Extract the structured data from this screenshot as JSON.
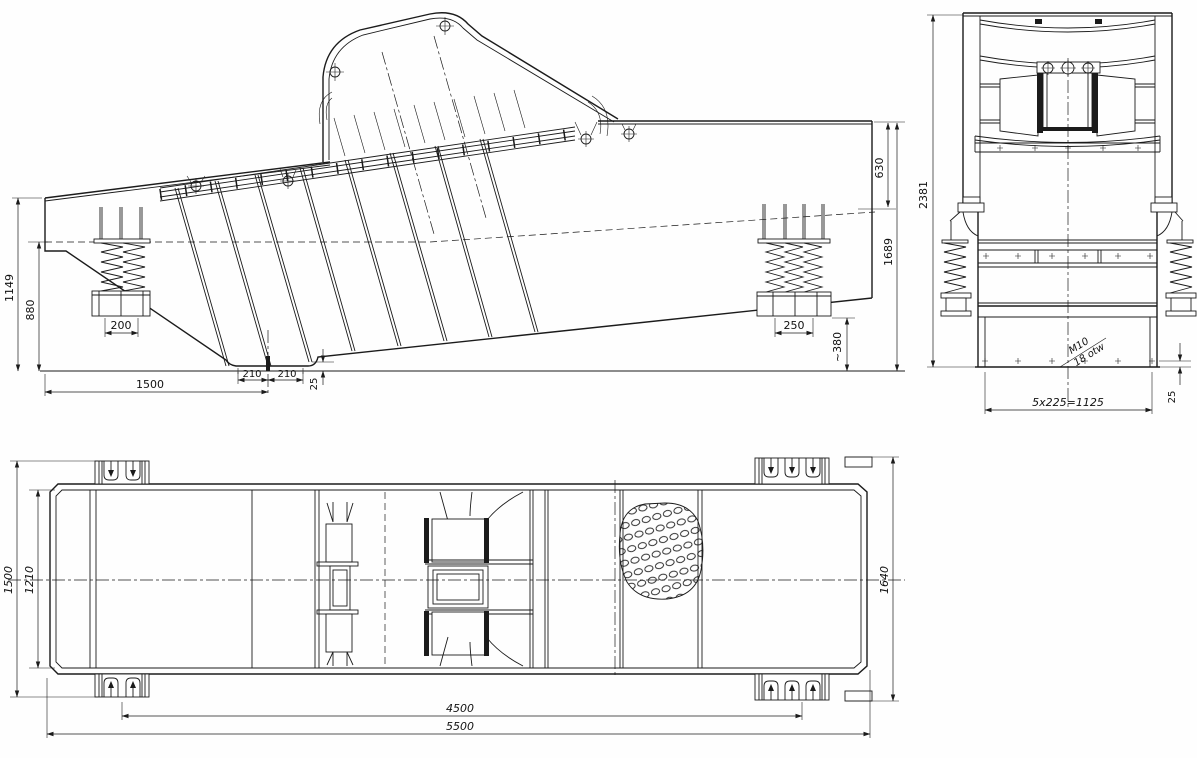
{
  "drawing": {
    "type": "engineering-3-view-drawing",
    "subject": "vibrating-screen-machine",
    "line_color": "#1b1b1b",
    "background": "#fefefe"
  },
  "views": {
    "side": {
      "label": "side-view",
      "dims": {
        "d1149": "1149",
        "d880": "880",
        "d200": "200",
        "d1500": "1500",
        "d210a": "210",
        "d210b": "210",
        "d25": "25",
        "d250": "250",
        "d380": "~380",
        "d630": "630",
        "d1689": "1689"
      }
    },
    "end": {
      "label": "end-view",
      "dims": {
        "d2381": "2381",
        "d1125": "5x225=1125",
        "d25": "25",
        "m10": "M10",
        "otw": "18 otw"
      }
    },
    "plan": {
      "label": "plan-view",
      "dims": {
        "d1500": "1500",
        "d1210": "1210",
        "d1640": "1640",
        "d4500": "4500",
        "d5500": "5500"
      }
    }
  }
}
